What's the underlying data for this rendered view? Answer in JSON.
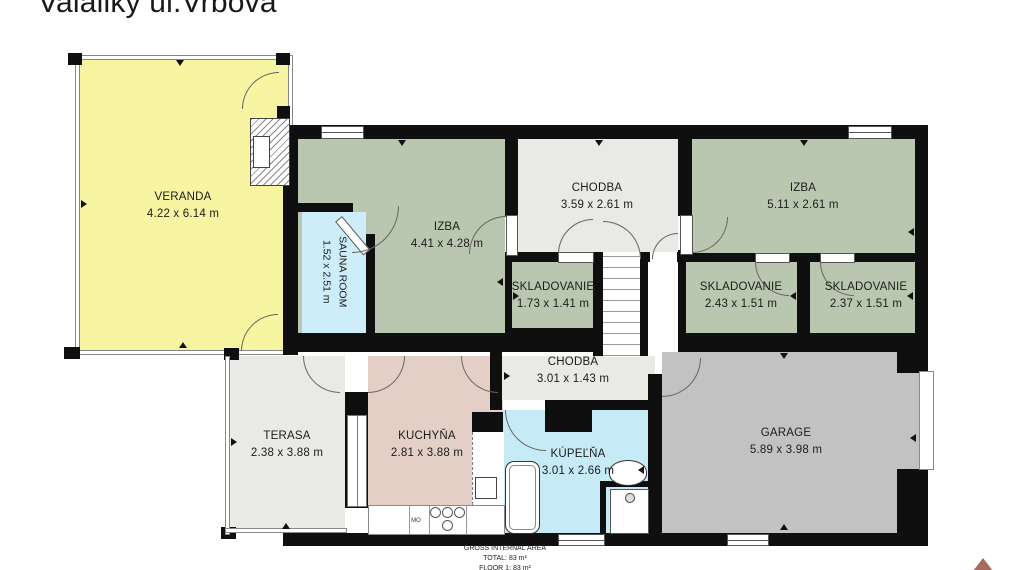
{
  "title": "Valaliky ul.Vrbová",
  "rooms": {
    "veranda": {
      "name": "VERANDA",
      "dims": "4.22 x 6.14 m"
    },
    "sauna": {
      "name": "SAUNA ROOM",
      "dims": "1.52 x 2.51 m"
    },
    "izba1": {
      "name": "IZBA",
      "dims": "4.41 x 4.28 m"
    },
    "chodba1": {
      "name": "CHODBA",
      "dims": "3.59 x 2.61 m"
    },
    "izba2": {
      "name": "IZBA",
      "dims": "5.11 x 2.61 m"
    },
    "sklad1": {
      "name": "SKLADOVANIE",
      "dims": "1.73 x 1.41 m"
    },
    "sklad2": {
      "name": "SKLADOVANIE",
      "dims": "2.43 x 1.51 m"
    },
    "sklad3": {
      "name": "SKLADOVANIE",
      "dims": "2.37 x 1.51 m"
    },
    "terasa": {
      "name": "TERASA",
      "dims": "2.38 x 3.88 m"
    },
    "kuchyna": {
      "name": "KUCHYŇA",
      "dims": "2.81 x 3.88 m"
    },
    "chodba2": {
      "name": "CHODBA",
      "dims": "3.01 x 1.43 m"
    },
    "kupelna": {
      "name": "KÚPEĽŇA",
      "dims": "3.01 x 2.66 m"
    },
    "garage": {
      "name": "GARAGE",
      "dims": "5.89 x 3.98 m"
    }
  },
  "appliances": {
    "microwave_label": "MO"
  },
  "footer": {
    "line1": "GROSS INTERNAL AREA",
    "line2": "TOTAL: 83 m²",
    "line3": "FLOOR 1: 83 m²"
  },
  "colors": {
    "wall": "#0f0f0f",
    "veranda": "#f8f5a2",
    "room_green": "#b9c7b1",
    "room_gray": "#e9e9e6",
    "sauna_blue": "#cdeef8",
    "kitchen_salmon": "#e3cfc6",
    "bath_cyan": "#c6eaf6",
    "garage_gray": "#c2c2c2",
    "logo": "#a86a5f"
  }
}
